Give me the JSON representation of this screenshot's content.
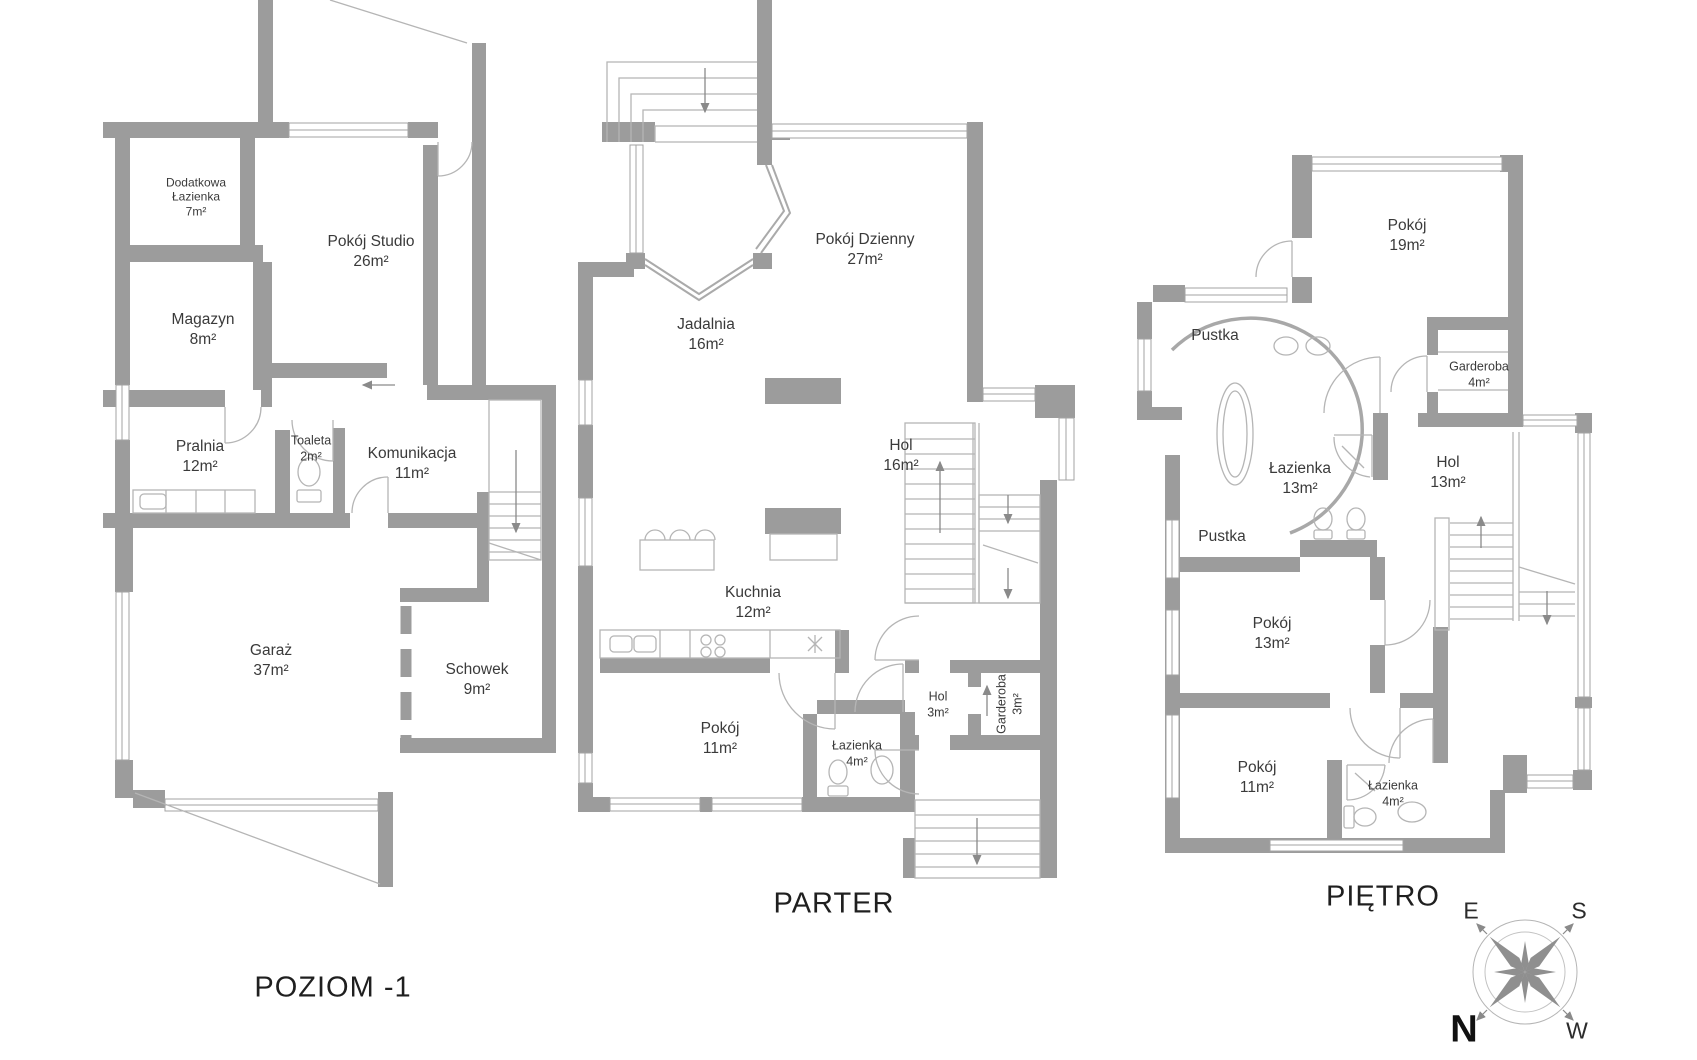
{
  "page": {
    "background": "#ffffff",
    "wall_color": "#9c9c9c",
    "thin_line_color": "#b5b5b5",
    "text_color": "#3a3a3a"
  },
  "floors": [
    {
      "id": "poziom-1",
      "title": "POZIOM -1",
      "rooms": [
        {
          "name": "Dodatkowa Łazienka",
          "area": "7m²"
        },
        {
          "name": "Pokój Studio",
          "area": "26m²"
        },
        {
          "name": "Magazyn",
          "area": "8m²"
        },
        {
          "name": "Pralnia",
          "area": "12m²"
        },
        {
          "name": "Toaleta",
          "area": "2m²"
        },
        {
          "name": "Komunikacja",
          "area": "11m²"
        },
        {
          "name": "Garaż",
          "area": "37m²"
        },
        {
          "name": "Schowek",
          "area": "9m²"
        }
      ]
    },
    {
      "id": "parter",
      "title": "PARTER",
      "rooms": [
        {
          "name": "Pokój Dzienny",
          "area": "27m²"
        },
        {
          "name": "Jadalnia",
          "area": "16m²"
        },
        {
          "name": "Hol",
          "area": "16m²"
        },
        {
          "name": "Kuchnia",
          "area": "12m²"
        },
        {
          "name": "Pokój",
          "area": "11m²"
        },
        {
          "name": "Łazienka",
          "area": "4m²"
        },
        {
          "name": "Hol",
          "area": "3m²"
        },
        {
          "name": "Garderoba",
          "area": "3m²"
        }
      ]
    },
    {
      "id": "pietro",
      "title": "PIĘTRO",
      "rooms": [
        {
          "name": "Pokój",
          "area": "19m²"
        },
        {
          "name": "Pustka",
          "area": ""
        },
        {
          "name": "Łazienka",
          "area": "13m²"
        },
        {
          "name": "Garderoba",
          "area": "4m²"
        },
        {
          "name": "Hol",
          "area": "13m²"
        },
        {
          "name": "Pustka",
          "area": ""
        },
        {
          "name": "Pokój",
          "area": "13m²"
        },
        {
          "name": "Pokój",
          "area": "11m²"
        },
        {
          "name": "Łazienka",
          "area": "4m²"
        }
      ]
    }
  ],
  "compass": {
    "east": "E",
    "south": "S",
    "north": "N",
    "west": "W"
  }
}
